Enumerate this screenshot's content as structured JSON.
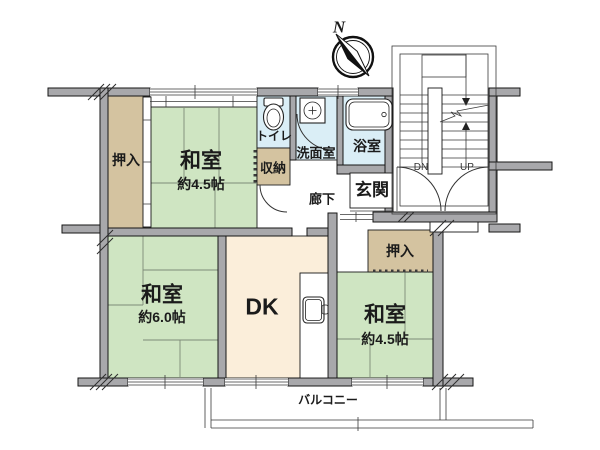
{
  "colors": {
    "tatami": "#cfe5c2",
    "closet": "#d4c3a0",
    "wet": "#daeef6",
    "dk": "#fbeeda",
    "wall": "#a8a8ab"
  },
  "rooms": {
    "washitsu_tl": {
      "name": "和室",
      "area": "約4.5帖"
    },
    "washitsu_bl": {
      "name": "和室",
      "area": "約6.0帖"
    },
    "washitsu_br": {
      "name": "和室",
      "area": "約4.5帖"
    },
    "dk": {
      "name": "DK"
    },
    "toilet": {
      "name": "トイレ"
    },
    "washroom": {
      "name": "洗面室"
    },
    "bathroom": {
      "name": "浴室"
    },
    "genkan": {
      "name": "玄関"
    },
    "corridor": {
      "name": "廊下"
    },
    "closet_left": {
      "name": "押入"
    },
    "closet_right": {
      "name": "押入"
    },
    "storage": {
      "name": "収納"
    },
    "balcony": {
      "name": "バルコニー"
    }
  },
  "stairs": {
    "down": "DN",
    "up": "UP"
  },
  "compass": {
    "north": "N"
  }
}
